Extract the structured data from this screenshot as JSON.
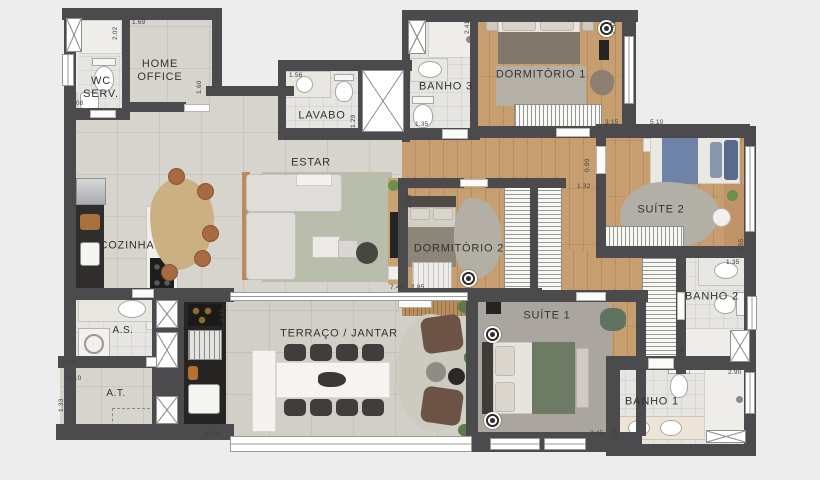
{
  "plan": {
    "type": "apartment-floor-plan",
    "language": "pt-BR",
    "rooms": [
      {
        "key": "wc_serv",
        "label": "WC\nSERV."
      },
      {
        "key": "home_office",
        "label": "HOME\nOFFICE"
      },
      {
        "key": "lavabo",
        "label": "LAVABO"
      },
      {
        "key": "banho3",
        "label": "BANHO 3"
      },
      {
        "key": "dormitorio1",
        "label": "DORMITÓRIO 1"
      },
      {
        "key": "suite2",
        "label": "SUÍTE 2"
      },
      {
        "key": "estar",
        "label": "ESTAR"
      },
      {
        "key": "cozinha",
        "label": "COZINHA"
      },
      {
        "key": "dormitorio2",
        "label": "DORMITÓRIO 2"
      },
      {
        "key": "banho2",
        "label": "BANHO 2"
      },
      {
        "key": "area_servico",
        "label": "A.S."
      },
      {
        "key": "area_tecnica",
        "label": "A.T."
      },
      {
        "key": "terraco_jantar",
        "label": "TERRAÇO / JANTAR"
      },
      {
        "key": "suite1",
        "label": "SUÍTE 1"
      },
      {
        "key": "banho1",
        "label": "BANHO 1"
      }
    ],
    "dims": [
      "2.02",
      "1.69",
      "1.60",
      "1.08",
      "1.56",
      "1.29",
      "2.41",
      "1.35",
      "2.41",
      "3.15",
      "5.10",
      "0.90",
      "1.32",
      "2.48",
      "7.43",
      "2.85",
      "2.55",
      "1.35",
      "2.30",
      "2.90",
      "1.98",
      "2.45",
      "1.60",
      "2.10",
      "1.33",
      "2.50",
      "6.35"
    ],
    "icons": {
      "viewpoint": "concentric-circles-marker",
      "shaft": "crossed-white-box",
      "shower_drain": "crossed-white-box"
    },
    "colors": {
      "background": "#ededee",
      "wall": "#4b4b4d",
      "wood_floor": "#c79e6f",
      "tile_floor": "#d7d4ce",
      "bath_floor": "#e6e5e1",
      "rug_sage": "#b9bdac",
      "bed_blue": "#6f83a6",
      "bed_green": "#6e7b64",
      "counter_dark": "#262523",
      "chair_rust": "#a76a41"
    }
  }
}
